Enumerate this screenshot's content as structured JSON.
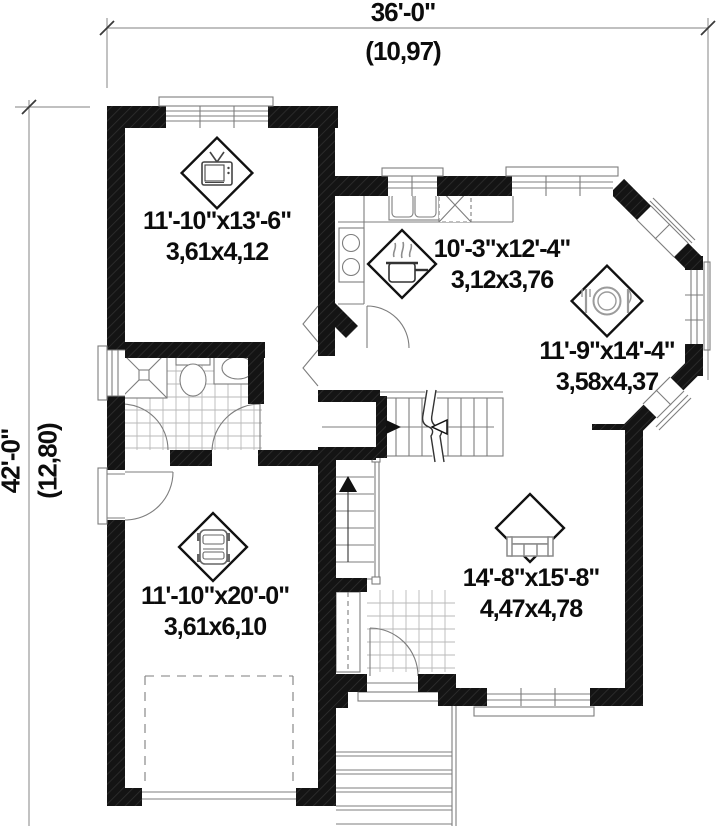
{
  "plan_title": "house-first-floor-plan",
  "dimensions": {
    "top": {
      "feet": "36'-0\"",
      "meters": "(10,97)"
    },
    "left": {
      "feet": "42'-0\"",
      "meters": "(12,80)"
    }
  },
  "rooms": [
    {
      "id": "family-room",
      "icon": "tv-icon",
      "imperial": "11'-10\"x13'-6\"",
      "metric": "3,61x4,12"
    },
    {
      "id": "kitchen",
      "icon": "cooking-pot-icon",
      "imperial": "10'-3\"x12'-4\"",
      "metric": "3,12x3,76"
    },
    {
      "id": "dining-room",
      "icon": "place-setting-icon",
      "imperial": "11'-9\"x14'-4\"",
      "metric": "3,58x4,37"
    },
    {
      "id": "garage",
      "icon": "car-icon",
      "imperial": "11'-10\"x20'-0\"",
      "metric": "3,61x6,10"
    },
    {
      "id": "living-room",
      "icon": "sofa-icon",
      "imperial": "14'-8\"x15'-8\"",
      "metric": "4,47x4,78"
    }
  ],
  "colors": {
    "wall": "#141414",
    "thin_line": "#8a8a8a",
    "tile_line": "#b9b9b9",
    "text": "#0c0c0c"
  }
}
